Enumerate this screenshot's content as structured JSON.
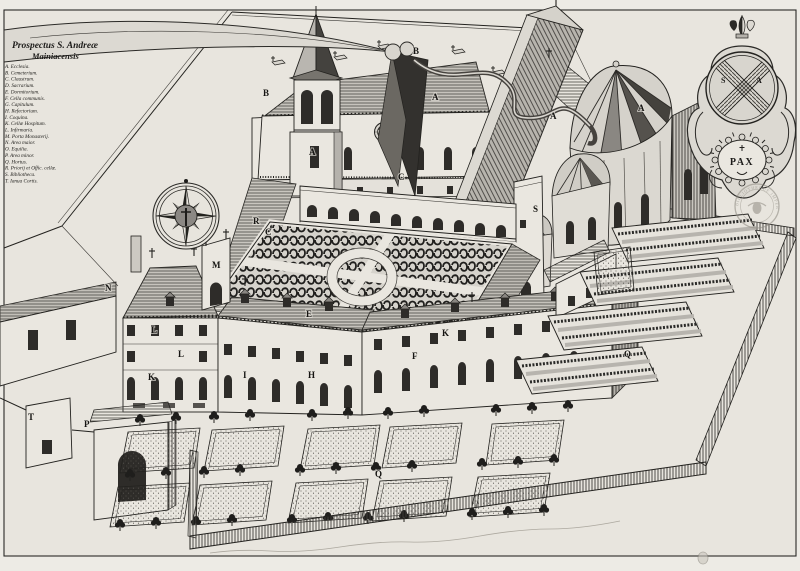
{
  "artwork": {
    "title_line1": "Prospectus S. Andreæ",
    "title_line2": "Mainiacensis"
  },
  "legend": {
    "items": [
      {
        "text": "A. Ecclesia."
      },
      {
        "text": "B. Cemeterium."
      },
      {
        "text": "C. Claustrum."
      },
      {
        "text": "D. Sacrarium."
      },
      {
        "text": "E. Dormitorium."
      },
      {
        "text": "F. Cella communis."
      },
      {
        "text": "G. Capitulum."
      },
      {
        "text": "H. Refectorium."
      },
      {
        "text": "I. Coquina."
      },
      {
        "text": "K. Cellæ Hospitum."
      },
      {
        "text": "L. Infirmaria."
      },
      {
        "text": "M. Porta Monasterij."
      },
      {
        "text": "N. Area maior."
      },
      {
        "text": "O. Equilia."
      },
      {
        "text": "P. Area minor."
      },
      {
        "text": "Q. Hortus."
      },
      {
        "text": "R. Priorij et Offic. cellæ."
      },
      {
        "text": "S. Bibliotheca."
      },
      {
        "text": "T. Ianua Cortis."
      }
    ]
  },
  "map_letters": [
    {
      "letter": "B"
    },
    {
      "letter": "B"
    },
    {
      "letter": "A"
    },
    {
      "letter": "A"
    },
    {
      "letter": "A"
    },
    {
      "letter": "A"
    },
    {
      "letter": "S"
    },
    {
      "letter": "C"
    },
    {
      "letter": "R"
    },
    {
      "letter": "C"
    },
    {
      "letter": "M"
    },
    {
      "letter": "N"
    },
    {
      "letter": "E"
    },
    {
      "letter": "L"
    },
    {
      "letter": "L"
    },
    {
      "letter": "K"
    },
    {
      "letter": "I"
    },
    {
      "letter": "H"
    },
    {
      "letter": "F"
    },
    {
      "letter": "K"
    },
    {
      "letter": "Q"
    },
    {
      "letter": "Q"
    },
    {
      "letter": "P"
    },
    {
      "letter": "T"
    }
  ],
  "cartouche": {
    "shield_letter_left": "S",
    "shield_letter_right": "A",
    "motto": "PAX",
    "stamp_text": "BIBLIOTHEQUE  IMPERIALE"
  },
  "colors": {
    "paper": "#e8e5de",
    "ink": "#1c1b19",
    "shade": "#c9c6c0"
  }
}
